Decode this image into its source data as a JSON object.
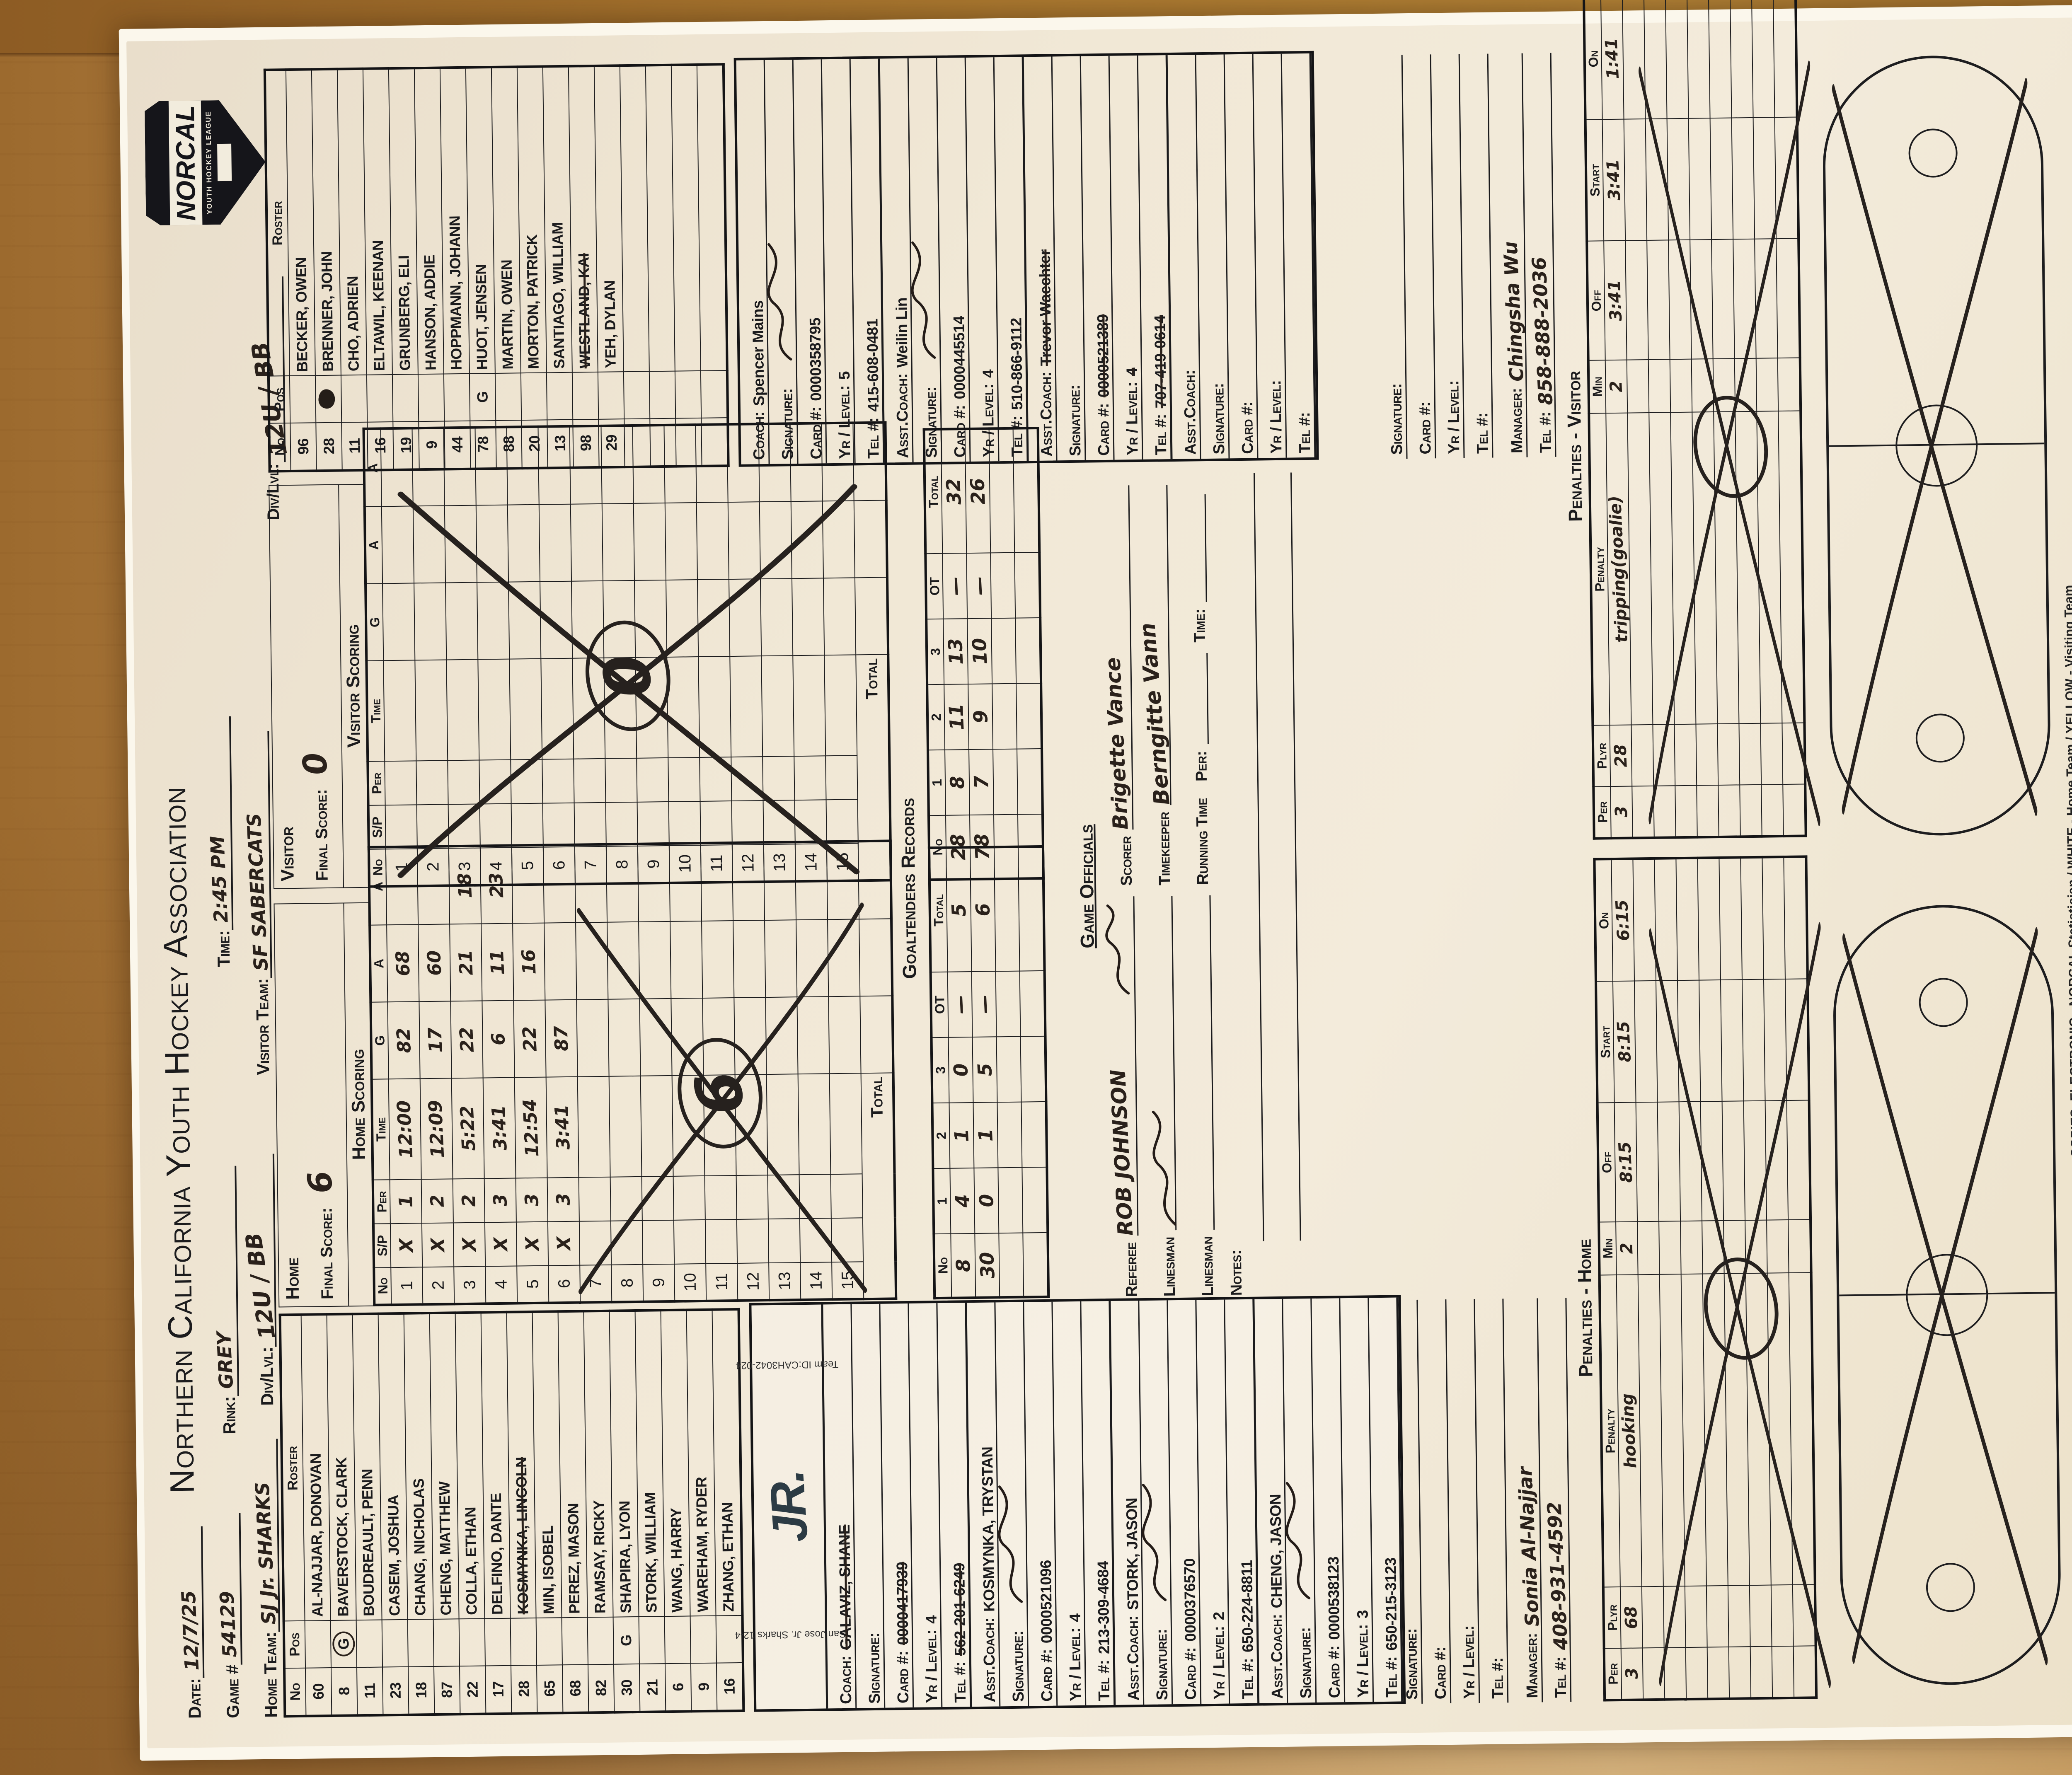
{
  "header": {
    "date_label": "Date:",
    "date": "12/7/25",
    "game_label": "Game #",
    "game": "54129",
    "home_team_label": "Home Team:",
    "home_team": "SJ Jr. SHARKS",
    "title": "Northern California Youth Hockey Association",
    "rink_label": "Rink:",
    "rink": "GREY",
    "time_label": "Time:",
    "time": "2:45 PM",
    "visitor_label": "Visitor Team:",
    "visitor": "SF SABERCATS",
    "div_label": "Div/Lvl:",
    "div_home": "12U / BB",
    "div_visitor": "12U / BB",
    "badge": {
      "name": "NORCAL",
      "sub": "YOUTH HOCKEY LEAGUE"
    }
  },
  "labels": {
    "no": "No",
    "pos": "Pos",
    "roster": "Roster",
    "sp": "S/P",
    "per": "Per",
    "time": "Time",
    "g": "G",
    "a": "A",
    "ot": "OT",
    "total": "Total",
    "home": "Home",
    "visitor": "Visitor",
    "final": "Final Score:",
    "coach": "Coach:",
    "asst": "Asst.Coach:",
    "signature": "Signature:",
    "card": "Card #:",
    "yr": "Yr / Level:",
    "tel": "Tel #:",
    "manager": "Manager:"
  },
  "home_roster": [
    {
      "no": "60",
      "pos": "",
      "name": "AL-NAJJAR, DONOVAN"
    },
    {
      "no": "8",
      "pos": "G",
      "pos_circled": true,
      "name": "BAVERSTOCK, CLARK"
    },
    {
      "no": "11",
      "pos": "",
      "name": "BOUDREAULT, PENN"
    },
    {
      "no": "23",
      "pos": "",
      "name": "CASEM, JOSHUA"
    },
    {
      "no": "18",
      "pos": "",
      "name": "CHANG, NICHOLAS"
    },
    {
      "no": "87",
      "pos": "",
      "name": "CHENG, MATTHEW"
    },
    {
      "no": "22",
      "pos": "",
      "name": "COLLA, ETHAN"
    },
    {
      "no": "17",
      "pos": "",
      "name": "DELFINO, DANTE"
    },
    {
      "no": "28",
      "pos": "",
      "name": "KOSMYNKA, LINCOLN",
      "struck": true
    },
    {
      "no": "65",
      "pos": "",
      "name": "MIN, ISOBEL"
    },
    {
      "no": "68",
      "pos": "",
      "name": "PEREZ, MASON"
    },
    {
      "no": "82",
      "pos": "",
      "name": "RAMSAY, RICKY"
    },
    {
      "no": "30",
      "pos": "G",
      "name": "SHAPIRA, LYON"
    },
    {
      "no": "21",
      "pos": "",
      "name": "STORK, WILLIAM"
    },
    {
      "no": "6",
      "pos": "",
      "name": "WANG, HARRY"
    },
    {
      "no": "9",
      "pos": "",
      "name": "WAREHAM, RYDER"
    },
    {
      "no": "16",
      "pos": "",
      "name": "ZHANG, ETHAN"
    }
  ],
  "visitor_roster": [
    {
      "no": "96",
      "pos": "",
      "name": "BECKER, OWEN"
    },
    {
      "no": "28",
      "pos": "",
      "pos_blot": true,
      "name": "BRENNER, JOHN"
    },
    {
      "no": "11",
      "pos": "",
      "name": "CHO, ADRIEN"
    },
    {
      "no": "16",
      "pos": "",
      "name": "ELTAWIL, KEENAN"
    },
    {
      "no": "19",
      "pos": "",
      "name": "GRUNBERG, ELI"
    },
    {
      "no": "9",
      "pos": "",
      "name": "HANSON, ADDIE"
    },
    {
      "no": "44",
      "pos": "",
      "name": "HOPPMANN, JOHANN"
    },
    {
      "no": "78",
      "pos": "G",
      "name": "HUOT, JENSEN"
    },
    {
      "no": "88",
      "pos": "",
      "name": "MARTIN, OWEN"
    },
    {
      "no": "20",
      "pos": "",
      "name": "MORTON, PATRICK"
    },
    {
      "no": "13",
      "pos": "",
      "name": "SANTIAGO, WILLIAM"
    },
    {
      "no": "98",
      "pos": "",
      "name": "WESTLAND, KAI",
      "struck": true
    },
    {
      "no": "29",
      "pos": "",
      "name": "YEH, DYLAN"
    },
    {
      "no": "",
      "pos": "",
      "name": ""
    },
    {
      "no": "",
      "pos": "",
      "name": ""
    },
    {
      "no": "",
      "pos": "",
      "name": ""
    },
    {
      "no": "",
      "pos": "",
      "name": ""
    }
  ],
  "scoring": {
    "home": {
      "team": "Home",
      "heading": "Home Scoring",
      "final": "6",
      "crossed_value": "6",
      "rows": [
        {
          "sp": "X",
          "per": "1",
          "time": "12:00",
          "g": "82",
          "a1": "68",
          "a2": ""
        },
        {
          "sp": "X",
          "per": "2",
          "time": "12:09",
          "g": "17",
          "a1": "60",
          "a2": ""
        },
        {
          "sp": "X",
          "per": "2",
          "time": "5:22",
          "g": "22",
          "a1": "21",
          "a2": "18"
        },
        {
          "sp": "X",
          "per": "3",
          "time": "3:41",
          "g": "6",
          "a1": "11",
          "a2": "23"
        },
        {
          "sp": "X",
          "per": "3",
          "time": "12:54",
          "g": "22",
          "a1": "16",
          "a2": ""
        },
        {
          "sp": "X",
          "per": "3",
          "time": "3:41",
          "g": "87",
          "a1": "",
          "a2": ""
        }
      ]
    },
    "visitor": {
      "team": "Visitor",
      "heading": "Visitor Scoring",
      "final": "0",
      "crossed_value": "0",
      "rows": []
    }
  },
  "goaltenders": {
    "heading": "Goaltenders Records",
    "home": [
      [
        "8",
        "4",
        "1",
        "0",
        "—",
        "5"
      ],
      [
        "30",
        "0",
        "1",
        "5",
        "—",
        "6"
      ],
      [
        "",
        "",
        "",
        "",
        "",
        ""
      ],
      [
        "",
        "",
        "",
        "",
        "",
        ""
      ]
    ],
    "visitor": [
      [
        "28",
        "8",
        "11",
        "13",
        "—",
        "32"
      ],
      [
        "78",
        "7",
        "9",
        "10",
        "—",
        "26"
      ],
      [
        "",
        "",
        "",
        "",
        "",
        ""
      ],
      [
        "",
        "",
        "",
        "",
        "",
        ""
      ]
    ]
  },
  "officials": {
    "heading": "Game Officials",
    "referee_label": "Referee",
    "referee": "ROB JOHNSON",
    "linesman_label": "Linesman",
    "scorer_label": "Scorer",
    "scorer": "Brigette Vance",
    "timekeeper_label": "Timekeeper",
    "timekeeper": "Berngitte Vann",
    "running_label": "Running Time",
    "per_label": "Per:",
    "time_label": "Time:",
    "notes_label": "Notes:"
  },
  "coach": {
    "home": {
      "team_line1": "San Jose Jr. Sharks 12-4",
      "team_line2": "Team ID:CAH3042-024",
      "logo": "JR.",
      "groups": [
        {
          "role": "Coach:",
          "name": "GALAVIZ, SHANE",
          "name_struck": true,
          "card": "0000417939",
          "card_struck": true,
          "yr": "4",
          "tel": "562-201-6249",
          "tel_struck": true,
          "signed": false
        },
        {
          "role": "Asst.Coach:",
          "name": "KOSMYNKA, TRYSTAN",
          "card": "0000521096",
          "yr": "4",
          "tel": "213-309-4684",
          "signed": true
        },
        {
          "role": "Asst.Coach:",
          "name": "STORK, JASON",
          "card": "0000376570",
          "yr": "2",
          "tel": "650-224-8811",
          "signed": true
        },
        {
          "role": "Asst.Coach:",
          "name": "CHENG, JASON",
          "card": "0000538123",
          "yr": "3",
          "tel": "650-215-3123",
          "signed": true
        }
      ],
      "manager": "Sonia Al-Najjar",
      "manager_tel": "408-931-4592"
    },
    "visitor": {
      "groups": [
        {
          "role": "Coach:",
          "name": "Spencer Mains",
          "card": "0000358795",
          "yr": "5",
          "tel": "415-608-0481",
          "signed": true
        },
        {
          "role": "Asst.Coach:",
          "name": "Weilin Lin",
          "card": "0000445514",
          "yr": "4",
          "tel": "510-866-9112",
          "signed": true
        },
        {
          "role": "Asst.Coach:",
          "name": "Trevor Waechter",
          "name_struck": true,
          "card": "0000521389",
          "card_struck": true,
          "yr": "4",
          "yr_struck": true,
          "tel": "707-419-0614",
          "tel_struck": true,
          "signed": false
        },
        {
          "role": "Asst.Coach:",
          "name": "",
          "card": "",
          "yr": "",
          "tel": "",
          "signed": false
        }
      ],
      "manager": "Chingsha Wu",
      "manager_tel": "858-888-2036"
    }
  },
  "penalties": {
    "home_heading": "Penalties - Home",
    "visitor_heading": "Penalties - Visitor",
    "cols": [
      "Per",
      "Plyr",
      "Penalty",
      "Min",
      "Off",
      "Start",
      "On"
    ],
    "home": [
      {
        "per": "3",
        "plyr": "68",
        "penalty": "hooking",
        "min": "2",
        "off": "8:15",
        "start": "8:15",
        "on": "6:15"
      }
    ],
    "visitor": [
      {
        "per": "3",
        "plyr": "28",
        "penalty": "tripping(goalie)",
        "min": "2",
        "off": "3:41",
        "start": "3:41",
        "on": "1:41"
      }
    ]
  },
  "footer": {
    "line1": "COPIES:    ELECTRONIC - NORCAL Statistician    /    WHITE  -  Home Team    /    YELLOW  -  Visiting Team",
    "line2": "FOR ADDITIONAL INFORMATION USE BACK OF WHITE SHEET ONLY  ----  ADDITIONAL STATISTICAL TRACKING SHOULD BE PUT ON A SECOND SCORESHEET",
    "line3": "ELECTRONIC SCORESHEET MUST BE RECEIVED WITHIN 24-HOURS BY NORCAL Statistician"
  }
}
